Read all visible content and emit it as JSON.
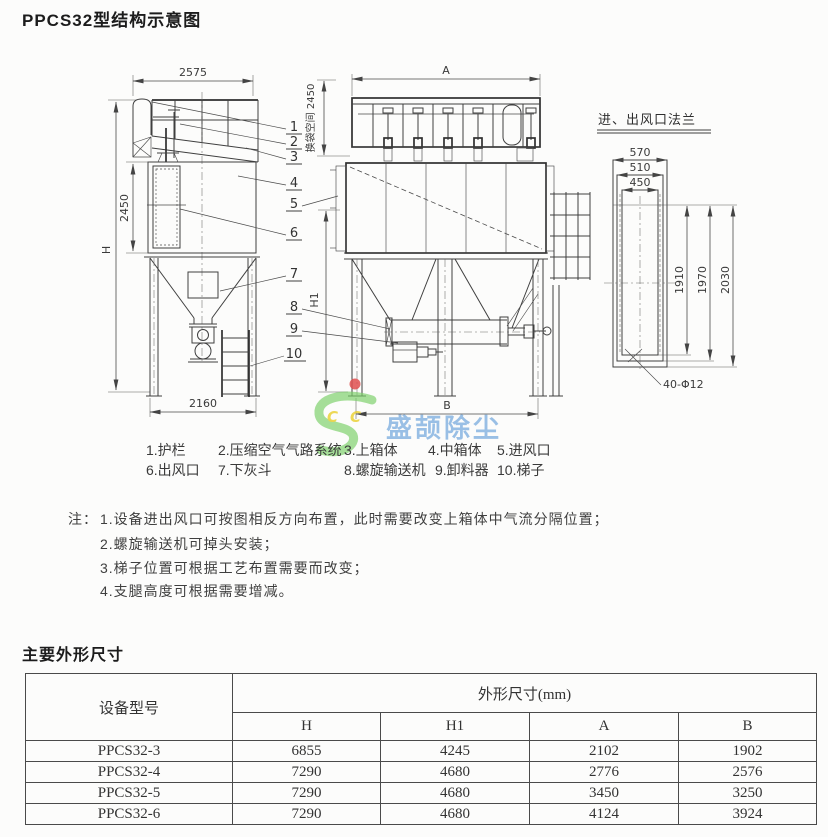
{
  "title": "PPCS32型结构示意图",
  "drawing": {
    "dims": {
      "w_top_left": "2575",
      "h_total": "H",
      "h_body": "2450",
      "w_base_left": "2160",
      "w_top_mid": "A",
      "w_base_mid": "B",
      "h_mid": "H1",
      "bag_space": "换袋空间 2450",
      "flange_title": "进、出风口法兰",
      "f_w1": "570",
      "f_w2": "510",
      "f_w3": "450",
      "f_h1": "1910",
      "f_h2": "1970",
      "f_h3": "2030",
      "bolt": "40-Φ12"
    },
    "callouts": [
      "1",
      "2",
      "3",
      "4",
      "5",
      "6",
      "7",
      "8",
      "9",
      "10"
    ]
  },
  "legend": {
    "row1": [
      "1.护栏",
      "2.压缩空气气路系统",
      "3.上箱体",
      "4.中箱体",
      "5.进风口"
    ],
    "row2": [
      "6.出风口",
      "7.下灰斗",
      "8.螺旋输送机",
      "9.卸料器",
      "10.梯子"
    ]
  },
  "notes": {
    "label": "注：",
    "items": [
      "1.设备进出风口可按图相反方向布置，此时需要改变上箱体中气流分隔位置；",
      "2.螺旋输送机可掉头安装；",
      "3.梯子位置可根据工艺布置需要而改变；",
      "4.支腿高度可根据需要增减。"
    ]
  },
  "table_section": {
    "heading": "主要外形尺寸",
    "col_model": "设备型号",
    "col_group": "外形尺寸(mm)",
    "sub_cols": [
      "H",
      "H1",
      "A",
      "B"
    ],
    "rows": [
      [
        "PPCS32-3",
        "6855",
        "4245",
        "2102",
        "1902"
      ],
      [
        "PPCS32-4",
        "7290",
        "4680",
        "2776",
        "2576"
      ],
      [
        "PPCS32-5",
        "7290",
        "4680",
        "3450",
        "3250"
      ],
      [
        "PPCS32-6",
        "7290",
        "4680",
        "4124",
        "3924"
      ]
    ]
  },
  "watermark": {
    "c1": "C",
    "c2": "C",
    "brand_text": "盛颉除尘",
    "green": "#7ccf6a",
    "blue": "#4a8fd4",
    "yellow": "#e9cf2e",
    "red": "#e05050"
  }
}
